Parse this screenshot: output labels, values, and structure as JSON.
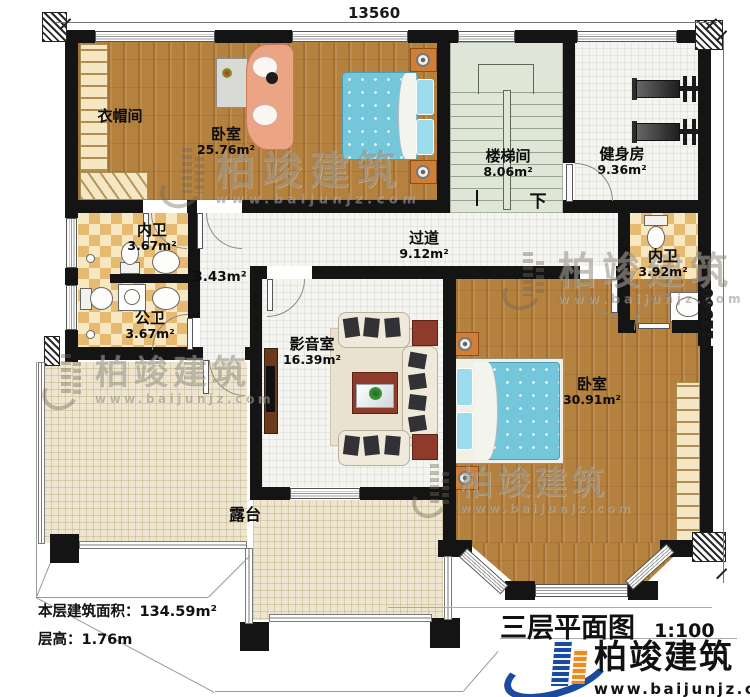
{
  "dims": {
    "top": "13560",
    "right": "12560"
  },
  "rooms": {
    "cloakroom": {
      "name": "衣帽间"
    },
    "bedroom1": {
      "name": "卧室",
      "area": "25.76m²"
    },
    "stairwell": {
      "name": "楼梯间",
      "area": "8.06m²"
    },
    "gym": {
      "name": "健身房",
      "area": "9.36m²"
    },
    "bath_master1": {
      "name": "内卫",
      "area": "3.67m²"
    },
    "bath_public": {
      "name": "公卫",
      "area": "3.67m²"
    },
    "vestibule": {
      "area": "3.43m²"
    },
    "hallway": {
      "name": "过道",
      "area": "9.12m²"
    },
    "media": {
      "name": "影音室",
      "area": "16.39m²"
    },
    "bath_master2": {
      "name": "内卫",
      "area": "3.92m²"
    },
    "bedroom2": {
      "name": "卧室",
      "area": "30.91m²"
    },
    "terrace": {
      "name": "露台"
    }
  },
  "stairs": {
    "down": "下"
  },
  "info": {
    "area_label": "本层建筑面积：",
    "area_value": "134.59m²",
    "height_label": "层高：",
    "height_value": "1.76m"
  },
  "title": {
    "text": "三层平面图",
    "scale": "1:100"
  },
  "brand": {
    "name": "柏竣建筑",
    "url": "www.baijunjz.com"
  },
  "colors": {
    "wall": "#141414",
    "wood": "#b5813f",
    "tile": "#f4f4f1",
    "checker": "#e7ba72",
    "stair": "#dfe5d7",
    "terrace": "#ede5d0",
    "bed_blue": "#74c6da",
    "brand_blue": "#1b4b9e",
    "brand_orange": "#ef8a1f"
  }
}
